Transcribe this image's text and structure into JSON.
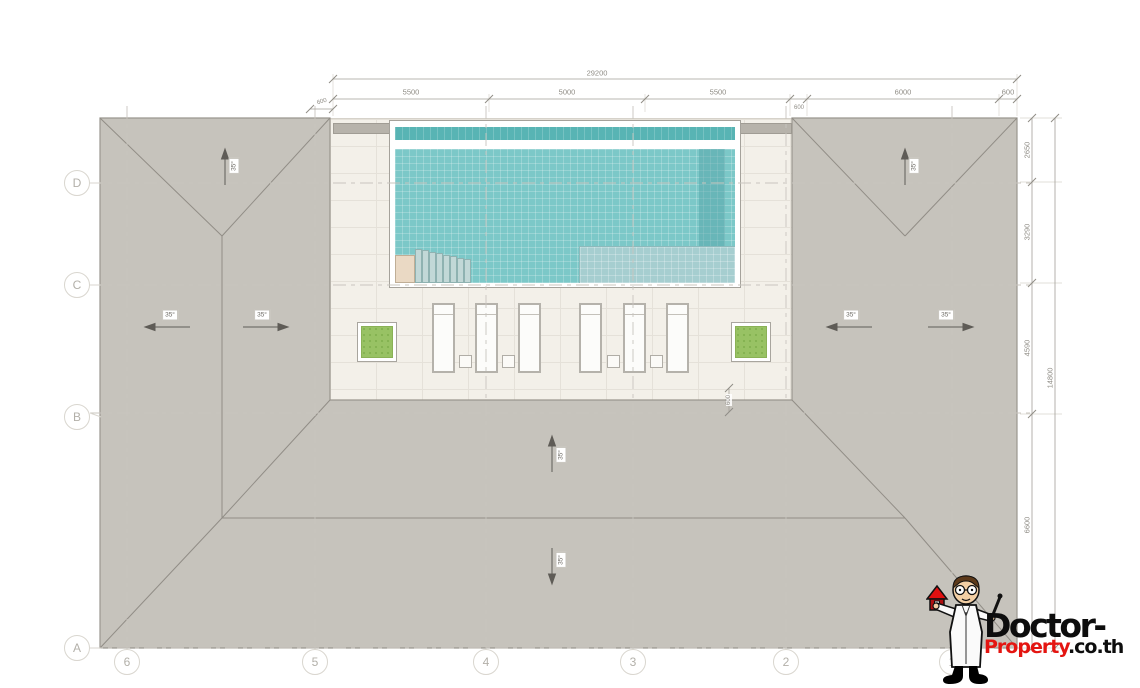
{
  "drawing_title": "roof-plan-with-pool-deck",
  "dims": {
    "top_total": "29200",
    "top_segments": [
      "5500",
      "5000",
      "5500",
      "6000",
      "600"
    ],
    "small_left": "600",
    "small_mid": "600",
    "right_inner": [
      "2650",
      "3290",
      "4590",
      "6600"
    ],
    "right_outer": "14800",
    "deck_offset": "600"
  },
  "grid": {
    "rows": [
      "D",
      "C",
      "B",
      "A"
    ],
    "cols": [
      "6",
      "5",
      "4",
      "3",
      "2",
      "1"
    ]
  },
  "slope": {
    "label": "35°"
  },
  "watermark": {
    "brand_top": "Doctor-",
    "brand_red": "Property",
    "brand_suffix": ".co.th"
  },
  "colors": {
    "roof_gray": "#c6c3bc",
    "deck_cream": "#f3f0e9",
    "pool_teal": "#7cc8c8",
    "gutter_teal": "#58b4b4",
    "shelf_teal": "#a6ced0",
    "planter_green": "#98c264",
    "brand_red": "#e41511",
    "brand_black": "#0d0d0d"
  }
}
